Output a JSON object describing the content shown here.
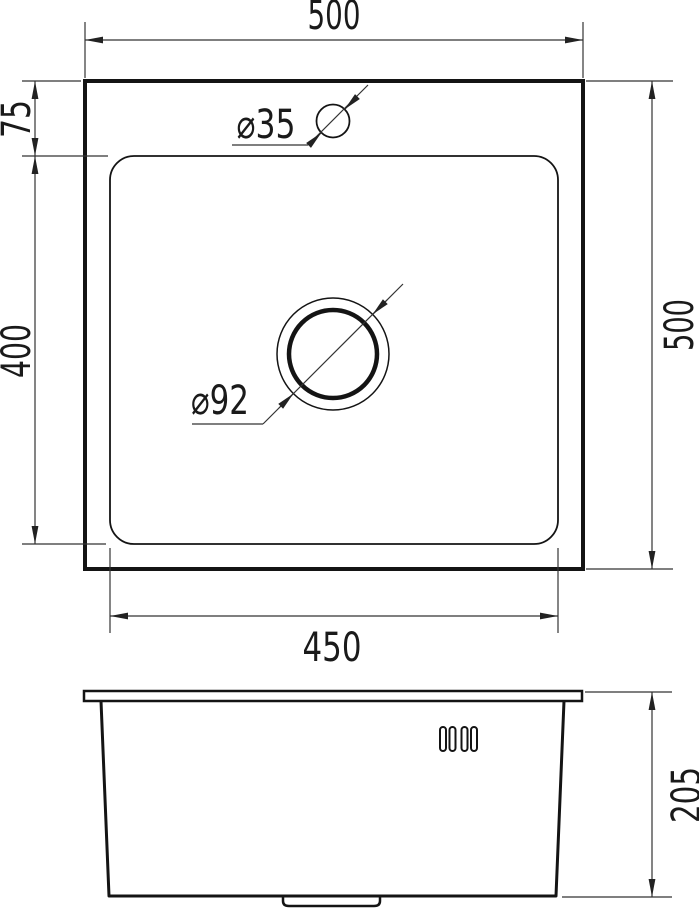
{
  "colors": {
    "background": "#ffffff",
    "object_line": "#141414",
    "dimension_line": "#333333",
    "text": "#1a1a1a"
  },
  "views": {
    "top": {
      "dim_overall_width": "500",
      "dim_overall_height": "500",
      "dim_rim_to_bowl": "75",
      "dim_bowl_length": "400",
      "dim_bowl_width": "450",
      "label_faucet_hole": "⌀35",
      "label_drain_hole": "⌀92"
    },
    "front": {
      "dim_depth": "205"
    }
  }
}
